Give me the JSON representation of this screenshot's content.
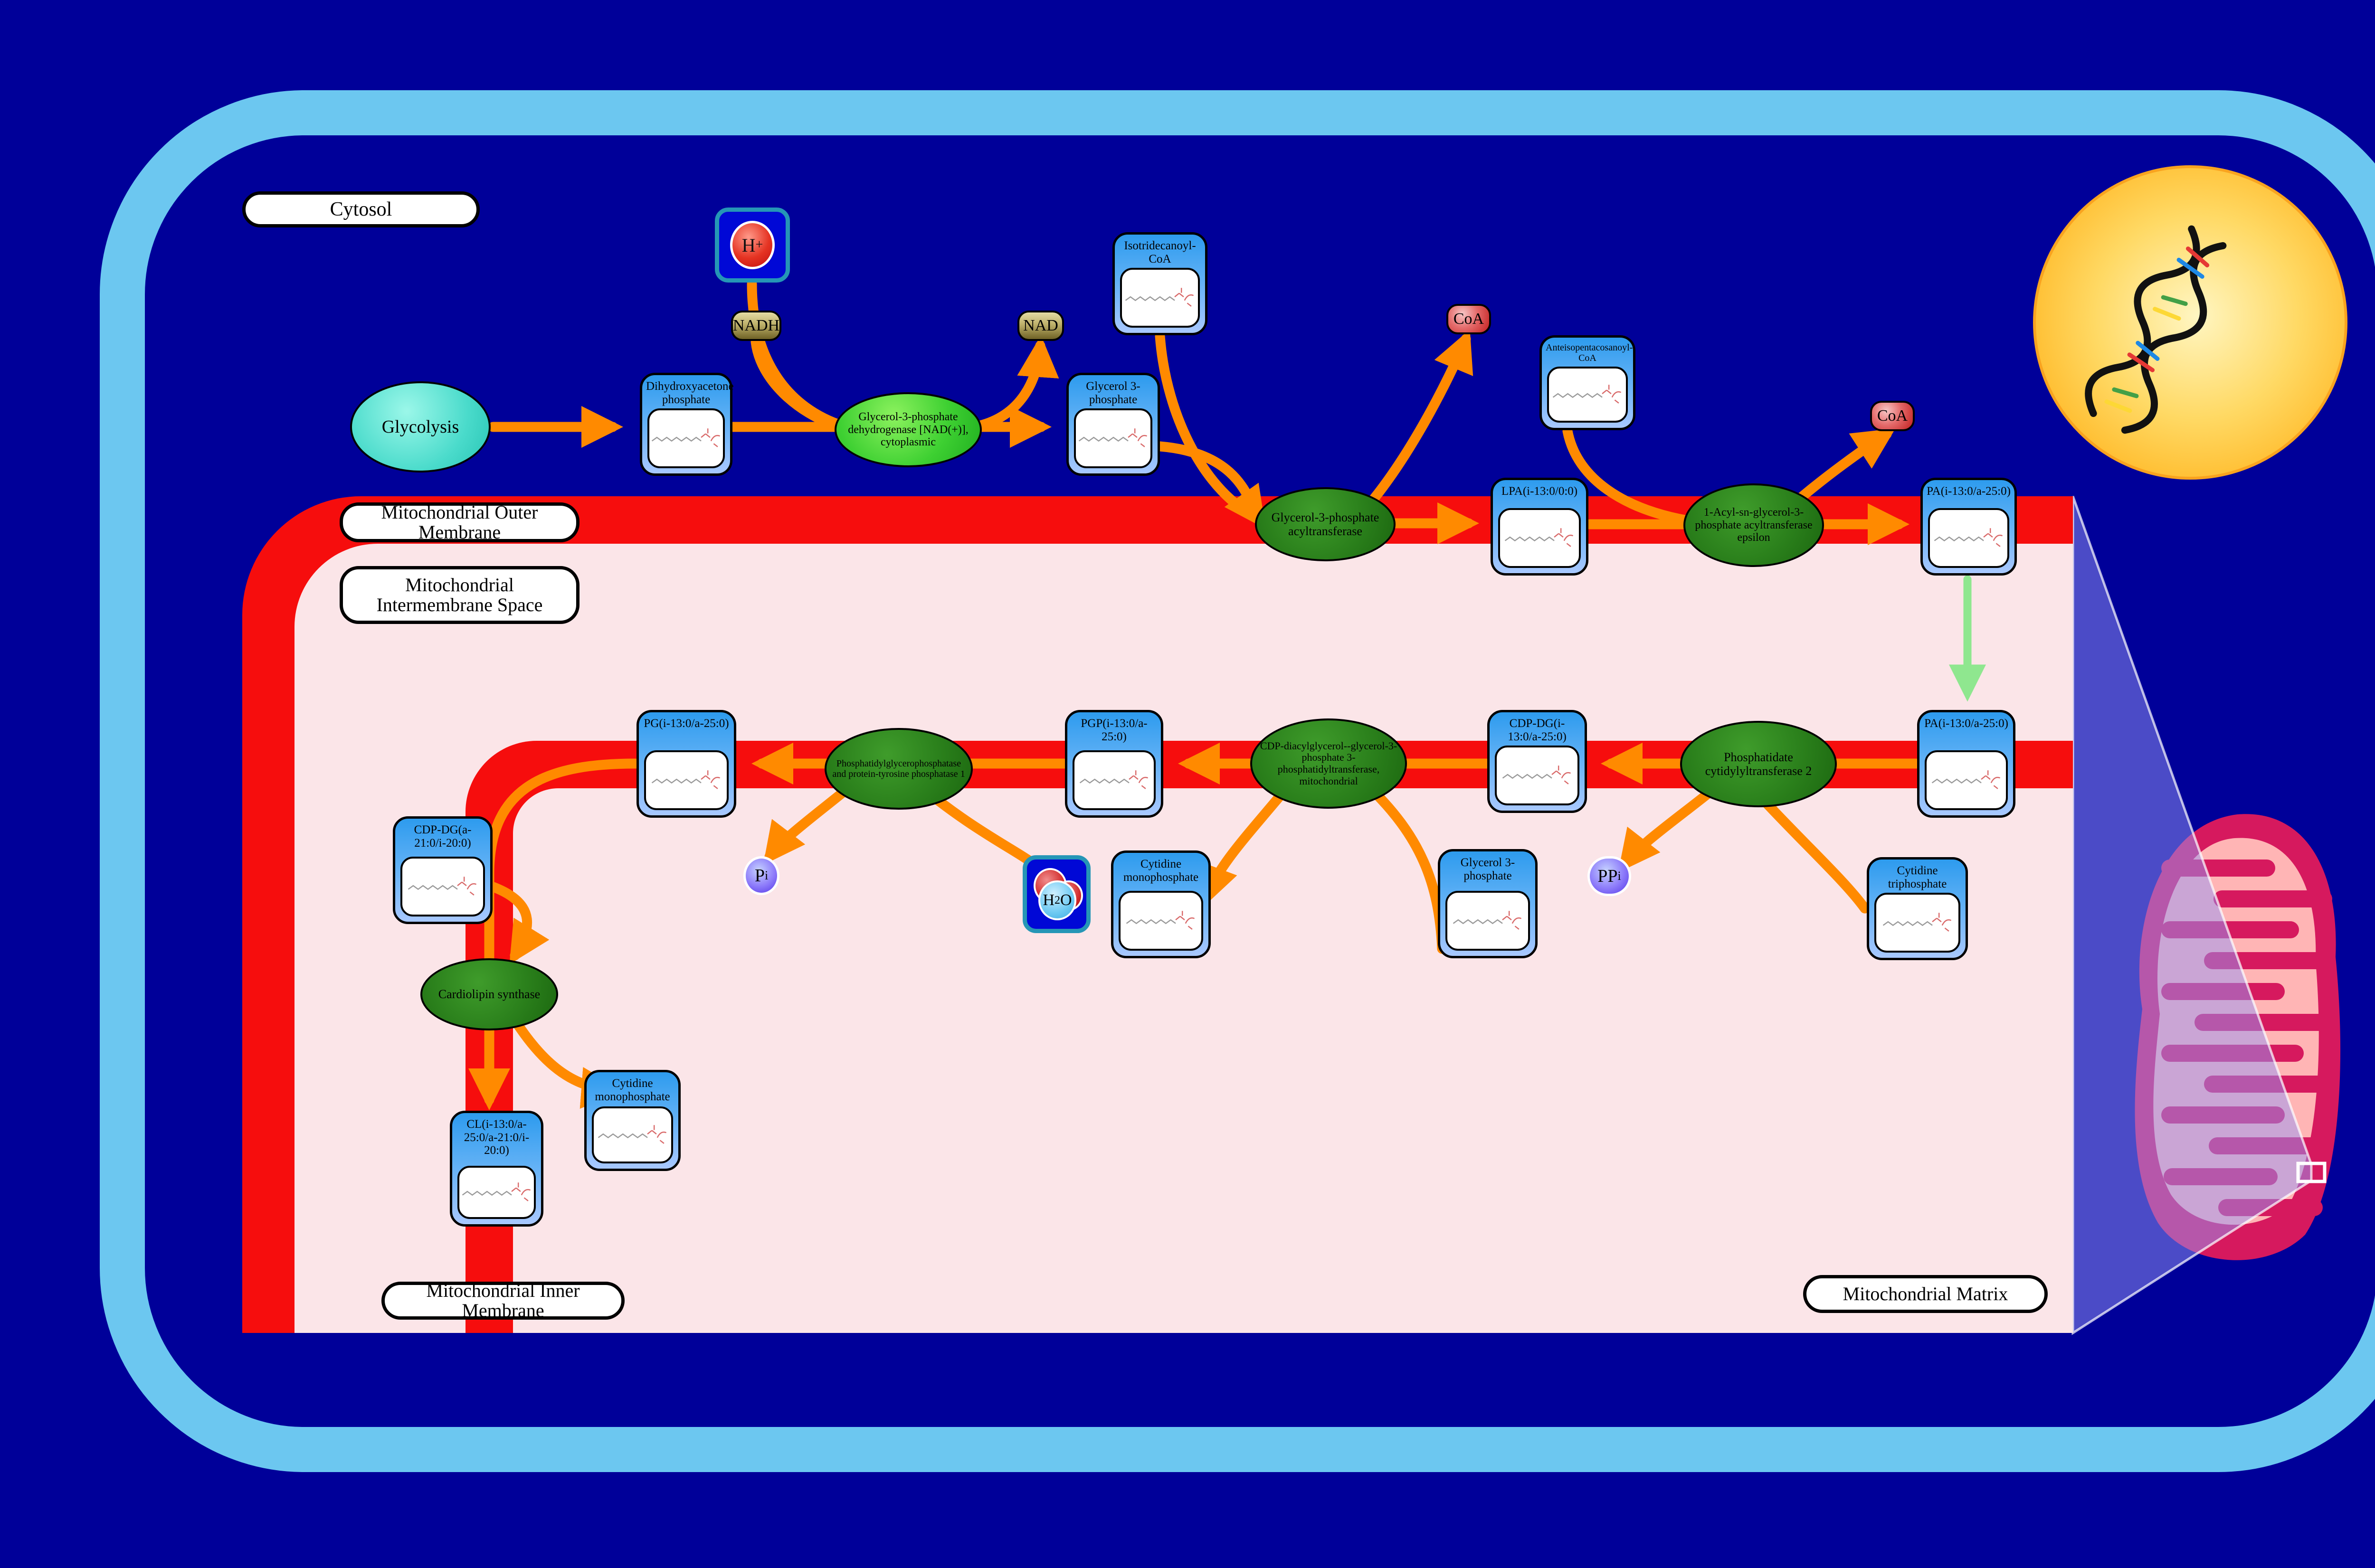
{
  "colors": {
    "background": "#000099",
    "cell_border": "#6CC7F0",
    "membrane_red": "#F60D0D",
    "intermembrane_pink": "#FBE5E8",
    "box_header_blue": "#2D9BEE",
    "enzyme_green_bright": "#3ED032",
    "enzyme_green_dark": "#2A7F1B",
    "arrow_orange": "#FF8A00",
    "arrow_green": "#8FE78F",
    "cofactor_khaki": "#BDB06A",
    "cofactor_red": "#C21F1F",
    "cofactor_purple": "#5436E8",
    "nucleus_yellow": "#FFB41E",
    "mitochondrion_crimson": "#D6195E"
  },
  "regions": {
    "cytosol": "Cytosol",
    "outer_membrane": "Mitochondrial Outer Membrane",
    "intermembrane_space": "Mitochondrial Intermembrane Space",
    "inner_membrane": "Mitochondrial Inner Membrane",
    "matrix": "Mitochondrial Matrix"
  },
  "process": {
    "glycolysis": "Glycolysis"
  },
  "metabolites": {
    "dhap": "Dihydroxyacetone phosphate",
    "isotridecanoyl_coa": "Isotridecanoyl-CoA",
    "g3p_cytosol": "Glycerol 3-phosphate",
    "anteisopentacosanoyl_coa": "Anteisopentacosanoyl-CoA",
    "lpa": "LPA(i-13:0/0:0)",
    "pa_outer": "PA(i-13:0/a-25:0)",
    "pa_inner": "PA(i-13:0/a-25:0)",
    "cdp_dg_inner": "CDP-DG(i-13:0/a-25:0)",
    "pgp": "PGP(i-13:0/a-25:0)",
    "pg": "PG(i-13:0/a-25:0)",
    "cdp_dg_lower": "CDP-DG(a-21:0/i-20:0)",
    "cl": "CL(i-13:0/a-25:0/a-21:0/i-20:0)",
    "cmp_mid": "Cytidine monophosphate",
    "g3p_mid": "Glycerol 3-phosphate",
    "ctp": "Cytidine triphosphate",
    "cmp_lower": "Cytidine monophosphate"
  },
  "enzymes": {
    "gpd_cytoplasmic": "Glycerol-3-phosphate dehydrogenase [NAD(+)], cytoplasmic",
    "gpat": "Glycerol-3-phosphate acyltransferase",
    "agpat_epsilon": "1-Acyl-sn-glycerol-3-phosphate acyltransferase epsilon",
    "cds2": "Phosphatidate cytidylyltransferase 2",
    "pgs1": "CDP-diacylglycerol--glycerol-3-phosphate 3-phosphatidyltransferase, mitochondrial",
    "ptpmt1": "Phosphatidylglycerophosphatase and protein-tyrosine phosphatase 1",
    "cls": "Cardiolipin synthase"
  },
  "cofactors": {
    "nadh": "NADH",
    "nad": "NAD",
    "h_plus": {
      "symbol": "H",
      "charge": "+"
    },
    "coa_1": "CoA",
    "coa_2": "CoA",
    "h2o": {
      "h": "H",
      "sub": "2",
      "o": "O"
    },
    "p_i": {
      "symbol": "P",
      "sub": "i"
    },
    "pp_i": {
      "symbol": "PP",
      "sub": "i"
    }
  }
}
